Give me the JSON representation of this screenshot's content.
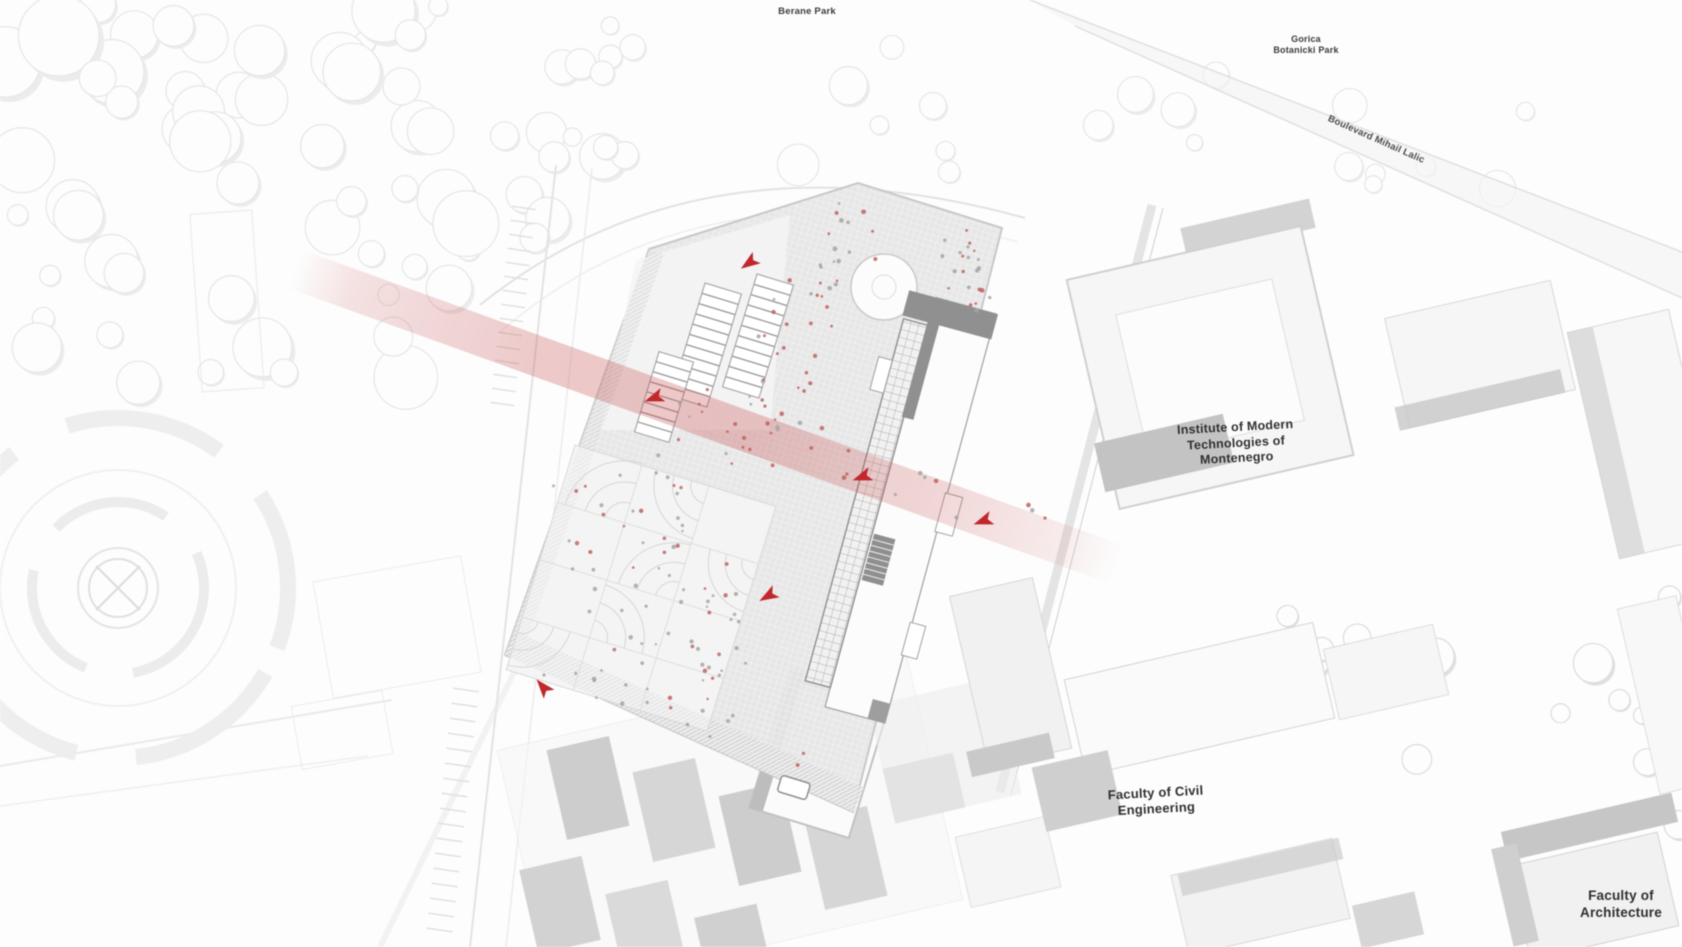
{
  "labels": {
    "park_top": "Berane Park",
    "park_right": {
      "line1": "Gorica",
      "line2": "Botanicki Park"
    },
    "boulevard": "Boulevard Mihail Lalic",
    "institute": {
      "line1": "Institute of Modern",
      "line2": "Technologies of",
      "line3": "Montenegro"
    },
    "faculty_civil": {
      "line1": "Faculty of Civil",
      "line2": "Engineering"
    },
    "faculty_architecture": {
      "line1": "Faculty of",
      "line2": "Architecture"
    }
  },
  "annotations": {
    "arrow_count": 6,
    "path_band": "red translucent pedestrian axis crossing the site"
  },
  "colors": {
    "accent_red": "#c1272d",
    "path_band_red": "#c85050",
    "building_gray": "#8f8f8f",
    "block_gray": "#c9c9c9",
    "plaza_gray": "#e7e7e7",
    "outline_gray": "#d8d8d8",
    "label_color": "#3a3a3a"
  }
}
